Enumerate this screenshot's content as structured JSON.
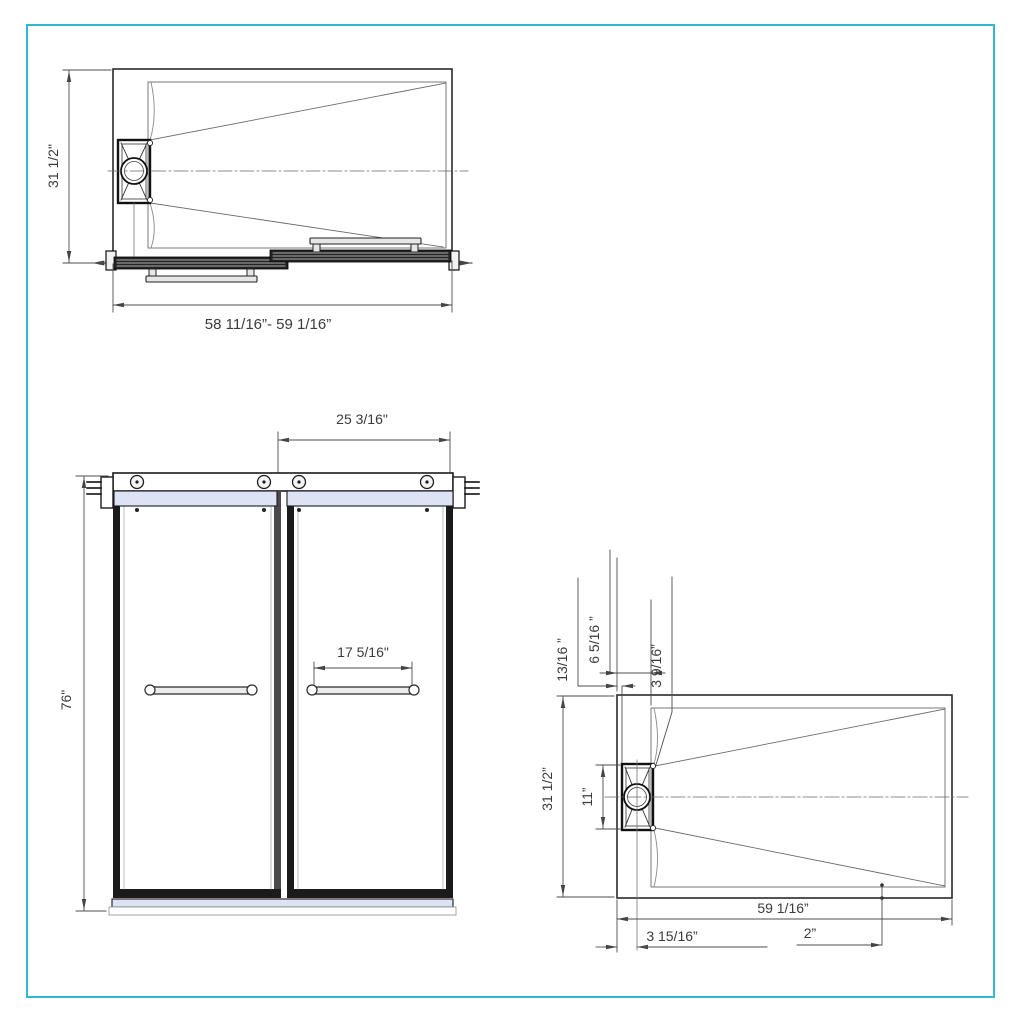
{
  "drawing_title": "sliding-shower-door-and-base-technical-drawing",
  "colors": {
    "page_border": "#2fb8d4",
    "glass_rail_blue": "#dbe3f4",
    "object_line": "#222222",
    "dimension_line": "#4a4a4a"
  },
  "top_view": {
    "depth_label": "31 1/2\"",
    "width_range_label": "58 11/16”- 59 1/16”"
  },
  "front_view": {
    "panel_width_label": "25 3/16\"",
    "height_label": "76\"",
    "handle_length_label": "17 5/16\""
  },
  "base_plan_view": {
    "rim_to_drain_label": "13/16 ”",
    "drain_inset_label": "6 5/16 ”",
    "drain_corner_label": "3 9/16”",
    "depth_label": "31 1/2”",
    "drain_length_label": "11”",
    "width_label": "59 1/16”",
    "drain_center_offset_label": "3 15/16”",
    "bottom_rim_label": "2”"
  }
}
